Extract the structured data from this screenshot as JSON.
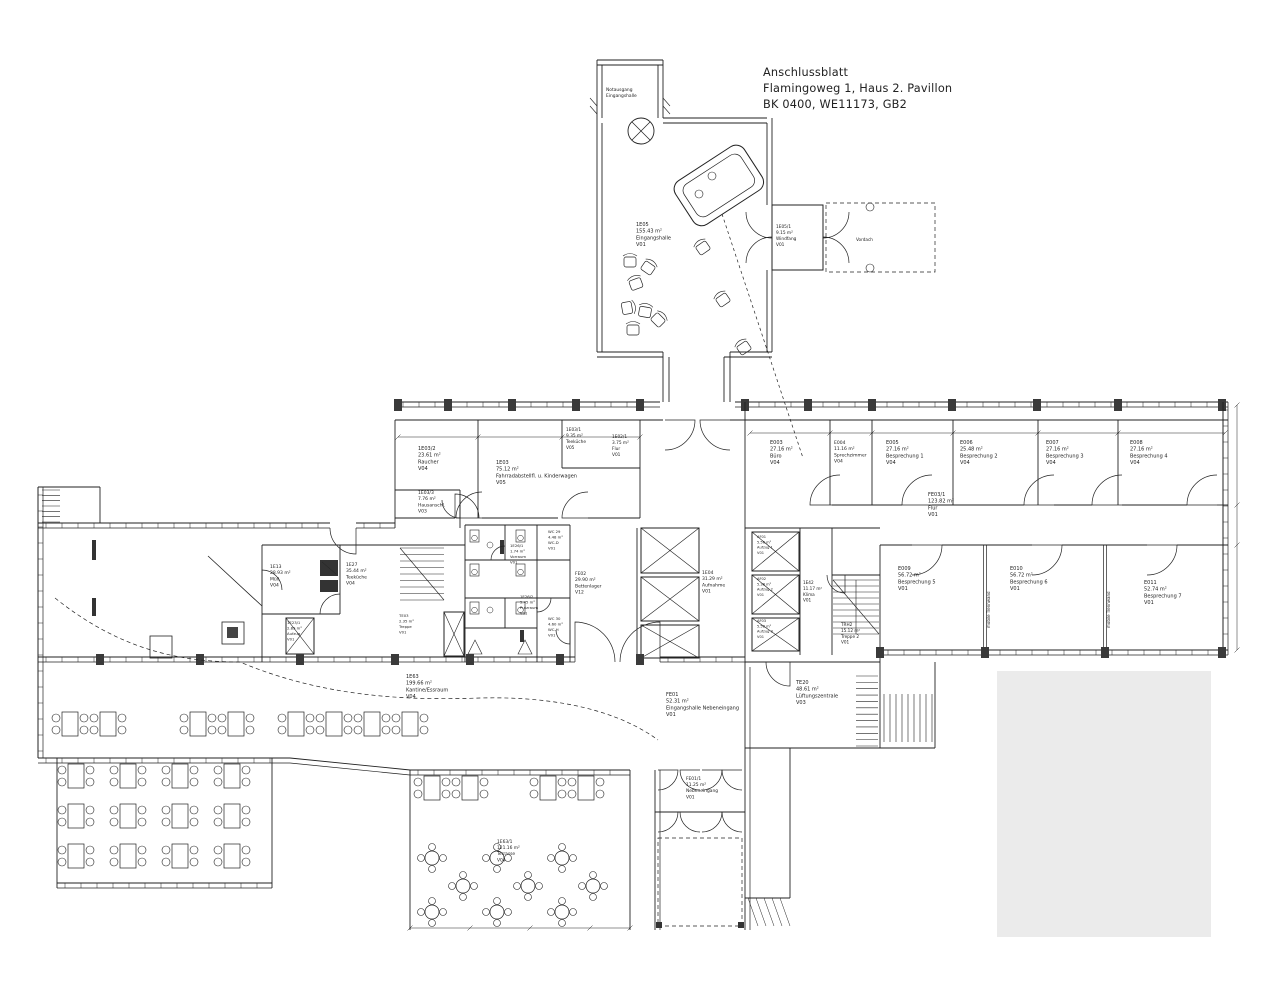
{
  "title_block": {
    "line1": "Anschlussblatt",
    "line2": "Flamingoweg 1, Haus 2. Pavillon",
    "line3": "BK 0400,  WE11173,  GB2"
  },
  "rooms": {
    "e05": {
      "id": "1E05",
      "area": "155.43 m²",
      "name": "Eingangshalle",
      "code": "V01"
    },
    "e05_1": {
      "id": "1E05/1",
      "area": "9.15 m²",
      "name": "Windfang",
      "code": "V01"
    },
    "e03_2": {
      "id": "1E03/2",
      "area": "23.61 m²",
      "name": "Raucher",
      "code": "V04"
    },
    "e03": {
      "id": "1E03",
      "area": "75.12 m²",
      "name": "Fahrradabstellfl. u. Kinderwagen",
      "code": "V05"
    },
    "e03_1": {
      "id": "1E03/1",
      "area": "9.35 m²",
      "name": "Teeküche",
      "code": "V05"
    },
    "e03_3": {
      "id": "1E03/3",
      "area": "7.76 m²",
      "name": "Hausanschl.",
      "code": "V03"
    },
    "e02_1": {
      "id": "1E02/1",
      "area": "3.75 m²",
      "name": "Flur",
      "code": "V01"
    },
    "e013": {
      "id": "1E13",
      "area": "28.93 m²",
      "name": "Müll",
      "code": "V04"
    },
    "e027": {
      "id": "1E27",
      "area": "35.44 m²",
      "name": "Teeküche",
      "code": "V04"
    },
    "e023_1": {
      "id": "1E23/1",
      "area": "2.89 m²",
      "name": "Aufzug",
      "code": "V01"
    },
    "te03": {
      "id": "TE03",
      "area": "2.35 m²",
      "name": "Treppe",
      "code": "V01"
    },
    "wc_d": {
      "id": "WC 29",
      "area": "4.48 m²",
      "name": "WC-D",
      "code": "V01"
    },
    "vorraum": {
      "id": "1E26/1",
      "area": "1.74 m²",
      "name": "Vorraum",
      "code": "V01"
    },
    "putzraum": {
      "id": "1E26/2",
      "area": "5.45 m²",
      "name": "Putzraum",
      "code": "V01"
    },
    "wc_h": {
      "id": "WC 30",
      "area": "4.60 m²",
      "name": "WC-H",
      "code": "V01"
    },
    "fe02": {
      "id": "FE02",
      "area": "29.90 m²",
      "name": "Bettenlager",
      "code": "V12"
    },
    "fe04": {
      "id": "1E04",
      "area": "31.29 m²",
      "name": "Aufnahme",
      "code": "V01"
    },
    "af01": {
      "id": "AF01",
      "area": "5.56 m²",
      "name": "Aufzug 1",
      "code": "V01"
    },
    "af02": {
      "id": "AF02",
      "area": "5.38 m²",
      "name": "Aufzug 2",
      "code": "V01"
    },
    "af03": {
      "id": "AF03",
      "area": "5.58 m²",
      "name": "Aufzug 3",
      "code": "V01"
    },
    "te42": {
      "id": "1E42",
      "area": "11.17 m²",
      "name": "Klima",
      "code": "V01"
    },
    "trh2": {
      "id": "TRH2",
      "area": "15.12 m²",
      "name": "Treppe 2",
      "code": "V01"
    },
    "e003": {
      "id": "E003",
      "area": "27.16 m²",
      "name": "Büro",
      "code": "V04"
    },
    "e004": {
      "id": "E004",
      "area": "11.16 m²",
      "name": "Sprechzimmer",
      "code": "V04"
    },
    "e005": {
      "id": "E005",
      "area": "27.16 m²",
      "name": "Besprechung 1",
      "code": "V04"
    },
    "e006": {
      "id": "E006",
      "area": "25.48 m²",
      "name": "Besprechung 2",
      "code": "V04"
    },
    "e007": {
      "id": "E007",
      "area": "27.16 m²",
      "name": "Besprechung 3",
      "code": "V04"
    },
    "e008": {
      "id": "E008",
      "area": "27.16 m²",
      "name": "Besprechung 4",
      "code": "V04"
    },
    "fe03_1": {
      "id": "FE03/1",
      "area": "123.82 m²",
      "name": "Flur",
      "code": "V01"
    },
    "e009": {
      "id": "E009",
      "area": "56.72 m²",
      "name": "Besprechung 5",
      "code": "V01"
    },
    "e010": {
      "id": "E010",
      "area": "56.72 m²",
      "name": "Besprechung 6",
      "code": "V01"
    },
    "e011": {
      "id": "E011",
      "area": "52.74 m²",
      "name": "Besprechung 7",
      "code": "V01"
    },
    "e063": {
      "id": "1E63",
      "area": "199.66 m²",
      "name": "Kantine/Essraum",
      "code": "V04"
    },
    "fe01": {
      "id": "FE01",
      "area": "52.31 m²",
      "name": "Eingangshalle Nebeneingang",
      "code": "V01"
    },
    "te20": {
      "id": "TE20",
      "area": "48.61 m²",
      "name": "Lüftungszentrale",
      "code": "V03"
    },
    "fe01_1": {
      "id": "FE01/1",
      "area": "11.25 m²",
      "name": "Nebeneingang",
      "code": "V01"
    },
    "e063_1": {
      "id": "1E63/1",
      "area": "121.16 m²",
      "name": "Terrasse",
      "code": "V04"
    }
  },
  "annotations": {
    "exit_line1": "Notausgang",
    "exit_line2": "Eingangshalle",
    "canopy": "Vordach",
    "partition": "mobile Trennwand"
  },
  "colors": {
    "line": "#222222",
    "placeholder": "#ebebeb",
    "background": "#ffffff"
  }
}
